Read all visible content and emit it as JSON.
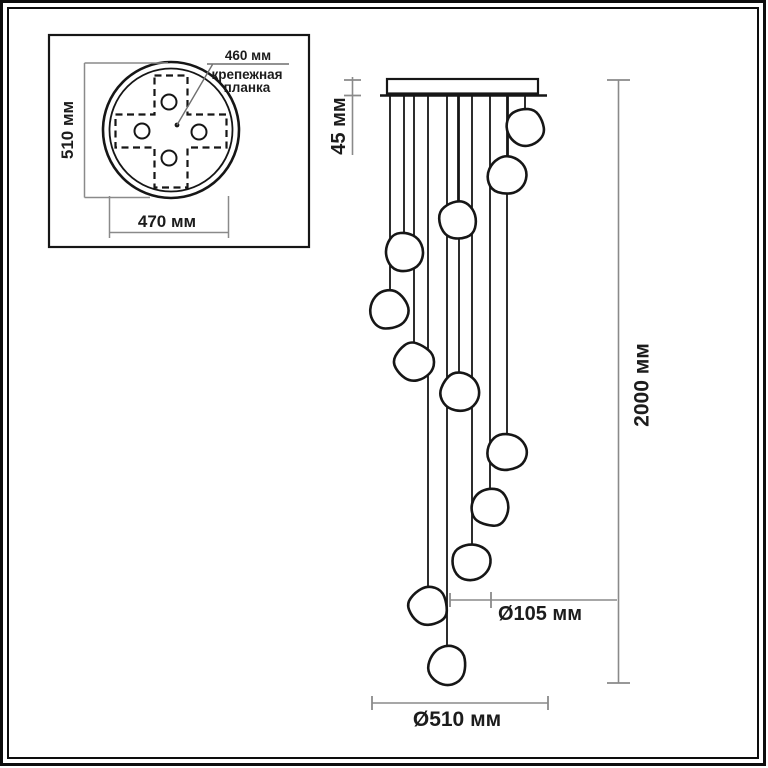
{
  "colors": {
    "drawing_line": "#161616",
    "dimension_line": "#8a8a8a",
    "label_text": "#1c1c1c",
    "background": "#ffffff"
  },
  "inset": {
    "height_label": "510 мм",
    "width_label": "470 мм",
    "plate_dim_label": "460 мм",
    "plate_caption_1": "крепежная",
    "plate_caption_2": "планка"
  },
  "main": {
    "canopy_height_label": "45 мм",
    "total_height_label": "2000 мм",
    "pendant_diameter_label": "Ø105 мм",
    "canopy_diameter_label": "Ø510 мм",
    "pendant_count": 12,
    "pendant_radius": 20.5,
    "cord_top_y": 96,
    "pendants": [
      {
        "cx": 525,
        "cy": 127
      },
      {
        "cx": 508,
        "cy": 176
      },
      {
        "cx": 458,
        "cy": 220
      },
      {
        "cx": 404,
        "cy": 251
      },
      {
        "cx": 390,
        "cy": 310
      },
      {
        "cx": 414,
        "cy": 362
      },
      {
        "cx": 459,
        "cy": 392
      },
      {
        "cx": 507,
        "cy": 452
      },
      {
        "cx": 490,
        "cy": 507
      },
      {
        "cx": 472,
        "cy": 562
      },
      {
        "cx": 428,
        "cy": 607
      },
      {
        "cx": 447,
        "cy": 665
      }
    ]
  }
}
